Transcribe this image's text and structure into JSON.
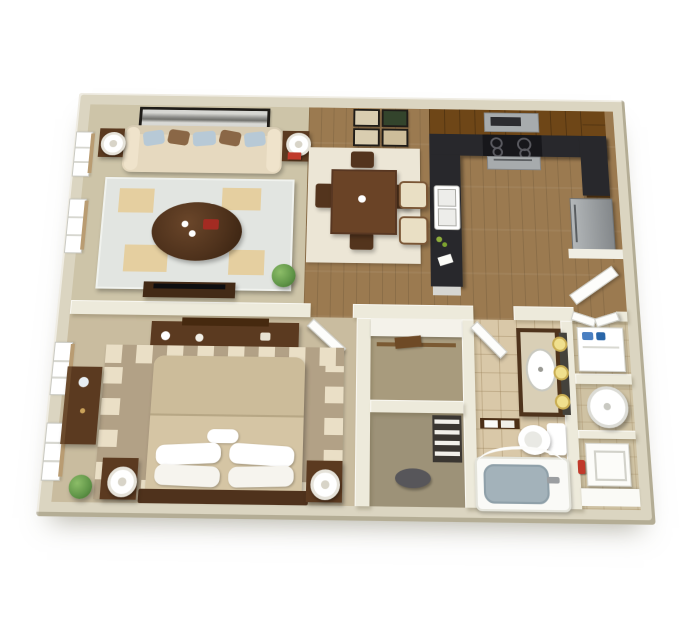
{
  "scene": {
    "type": "3d-floor-plan",
    "subject": "Isometric 3D rendering of a one-bedroom, one-bathroom apartment floor plan on a white background",
    "background": "#ffffff",
    "no_visible_text": true
  },
  "palette": {
    "wallOut": "#dbd5c1",
    "wallIn": "#edeadb",
    "livingFloor": "#cdc4a8",
    "wood": "#9b7a50",
    "bedFloor": "#c9bc9f",
    "tile": "#d9c8a8",
    "closetFloor": "#a89b7d",
    "dressFloor": "#9d9278",
    "rightFloor": "#cfc2a3",
    "dkwood": "#5b3a20",
    "dkwood2": "#6a4326",
    "cab": "#6e4617",
    "counter": "#28282c",
    "sofa": "#e6d9bf",
    "pillowBlue": "#b7c9d6",
    "pillowBrown": "#8a6746",
    "rugLiving": "#e2e5e1",
    "rugTan": "#e5cfa0",
    "rugDining": "#ece6d6",
    "rugBed": "#b2a186",
    "rugSq": "#eadfc6",
    "bedspread": "#d5c5a4",
    "tub": "#a3b2ba",
    "plant": "#5f9447",
    "steel": "#a7abad",
    "accentRed": "#c03a2b",
    "sconce": "#f0e08e",
    "detergent": "#4a7fc1",
    "sill": "#b99c72",
    "frame": "#1f1c18"
  },
  "rooms": [
    {
      "name": "living-room",
      "floor": "tan carpet",
      "contents": [
        "sofa with blue and brown pillows",
        "two end tables with white lamps",
        "red books accent",
        "light area rug with tan blocks",
        "round dark-wood coffee table with red tray",
        "potted plant",
        "tv console",
        "panoramic wall art",
        "two windows"
      ]
    },
    {
      "name": "dining-area",
      "floor": "hardwood",
      "contents": [
        "square dark-wood table",
        "four dark-wood chairs",
        "cream rug",
        "grid of four framed pictures"
      ]
    },
    {
      "name": "kitchen",
      "floor": "hardwood",
      "contents": [
        "dark brown cabinetry",
        "black granite counters",
        "cooktop range with oven",
        "microwave hood",
        "double-basin white sink in peninsula",
        "two cream bar stools",
        "stainless refrigerator"
      ]
    },
    {
      "name": "entry-foyer",
      "floor": "hardwood",
      "contents": [
        "white front door shown open"
      ]
    },
    {
      "name": "bedroom",
      "floor": "tan carpet",
      "contents": [
        "bed with tan comforter and white pillows",
        "dark-wood headboard",
        "two nightstands with round lamps",
        "tall dresser",
        "long dresser-desk",
        "bordered area rug with cream squares",
        "potted plant",
        "two windows",
        "white door shown open"
      ]
    },
    {
      "name": "walk-in-closet",
      "floor": "carpet",
      "contents": [
        "white shelf",
        "wood hanging rod",
        "folded clothes"
      ]
    },
    {
      "name": "dressing-nook",
      "floor": "carpet",
      "contents": [
        "gray oval mat",
        "linen shelves"
      ]
    },
    {
      "name": "bathroom",
      "floor": "tile",
      "contents": [
        "dark-wood vanity with oval sink",
        "mirror",
        "three round sconce lights",
        "toilet",
        "bathtub with gray-blue basin",
        "curved shower rod",
        "towel bar with towels",
        "white door shown open"
      ]
    },
    {
      "name": "laundry-closet",
      "contents": [
        "white washer",
        "blue detergent bottles",
        "bifold doors"
      ]
    },
    {
      "name": "water-heater-closet",
      "contents": [
        "round white water heater"
      ]
    },
    {
      "name": "utility-room",
      "floor": "tile",
      "contents": [
        "white dryer appliance",
        "red fire extinguisher",
        "white counter"
      ]
    }
  ]
}
